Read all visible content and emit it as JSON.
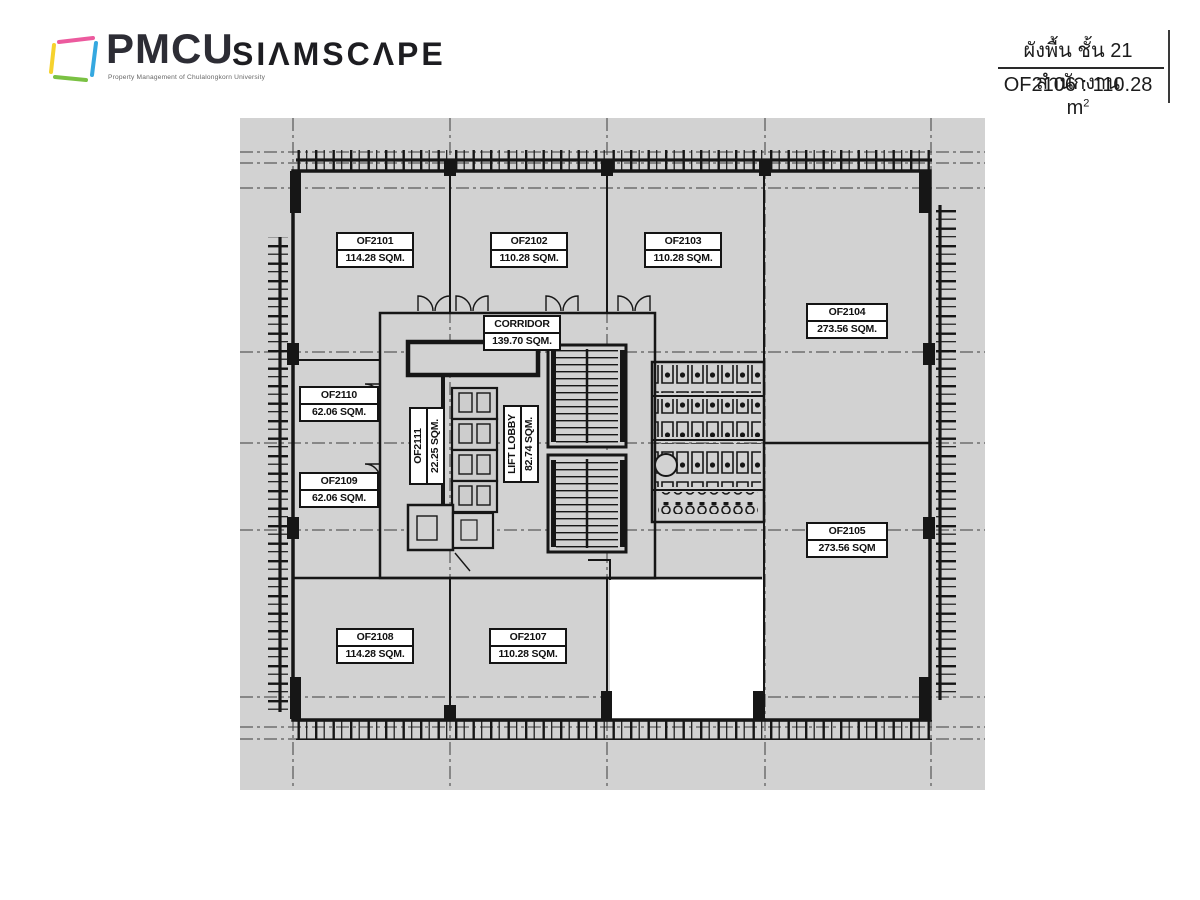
{
  "header": {
    "brand": "PMCU",
    "brand_tagline": "Property Management of Chulalongkorn University",
    "brand_secondary": "SIΛMSCΛPE",
    "plan_title_thai": "ผังพื้น ชั้น 21 สำนักงาน",
    "unit_summary": "OF2106 : 110.28 m",
    "unit_summary_sup": "2"
  },
  "floorplan": {
    "floor": "21",
    "highlighted_unit": "OF2106",
    "colors": {
      "canvas": "#d2d2d2",
      "walls": "#161616",
      "highlight": "#ffffff"
    },
    "rooms": {
      "of2101": {
        "name": "OF2101",
        "area": "114.28 SQM."
      },
      "of2102": {
        "name": "OF2102",
        "area": "110.28 SQM."
      },
      "of2103": {
        "name": "OF2103",
        "area": "110.28 SQM."
      },
      "of2104": {
        "name": "OF2104",
        "area": "273.56 SQM."
      },
      "of2105": {
        "name": "OF2105",
        "area": "273.56 SQM"
      },
      "of2110": {
        "name": "OF2110",
        "area": "62.06 SQM."
      },
      "of2109": {
        "name": "OF2109",
        "area": "62.06 SQM."
      },
      "of2108": {
        "name": "OF2108",
        "area": "114.28 SQM."
      },
      "of2107": {
        "name": "OF2107",
        "area": "110.28 SQM."
      },
      "corridor": {
        "name": "CORRIDOR",
        "area": "139.70 SQM."
      },
      "of2111": {
        "name": "OF2111",
        "area": "22.25 SQM."
      },
      "lift_lobby": {
        "name": "LIFT LOBBY",
        "area": "82.74 SQM."
      }
    }
  }
}
